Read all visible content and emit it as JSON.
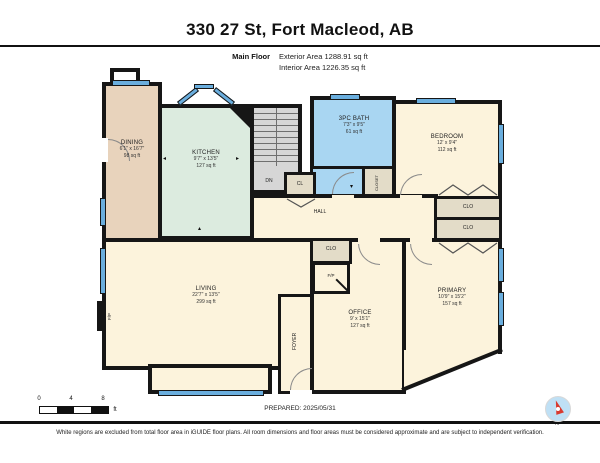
{
  "header": {
    "title": "330 27 St, Fort Macleod, AB",
    "floor_label": "Main Floor",
    "exterior_area": "Exterior Area 1288.91 sq ft",
    "interior_area": "Interior Area 1226.35 sq ft"
  },
  "rooms": {
    "dining": {
      "name": "DINING",
      "dims": "6'1\" x 16'7\"",
      "area": "98 sq ft"
    },
    "kitchen": {
      "name": "KITCHEN",
      "dims": "9'7\" x 13'5\"",
      "area": "127 sq ft"
    },
    "bath": {
      "name": "3PC BATH",
      "dims": "7'3\" x 9'5\"",
      "area": "61 sq ft"
    },
    "bedroom": {
      "name": "BEDROOM",
      "dims": "12' x 9'4\"",
      "area": "112 sq ft"
    },
    "living": {
      "name": "LIVING",
      "dims": "22'7\" x 13'5\"",
      "area": "299 sq ft"
    },
    "office": {
      "name": "OFFICE",
      "dims": "9' x 15'1\"",
      "area": "127 sq ft"
    },
    "primary": {
      "name": "PRIMARY",
      "dims": "10'9\" x 15'2\"",
      "area": "157 sq ft"
    }
  },
  "labels": {
    "hall": "HALL",
    "foyer": "FOYER",
    "dn": "DN",
    "cl": "CL",
    "closet": "CLOSET",
    "clo": "CLO",
    "fp": "F/P"
  },
  "scale": {
    "t0": "0",
    "t4": "4",
    "t8": "8",
    "unit": "ft"
  },
  "footer": {
    "prepared": "PREPARED: 2025/05/31",
    "compass_n": "N",
    "disclaimer": "White regions are excluded from total floor area in iGUIDE floor plans. All room dimensions and floor areas must be considered approximate and are subject to independent verification."
  },
  "colors": {
    "wall": "#161616",
    "window_blue": "#6aaede",
    "bath_blue": "#a9d6f2",
    "dining_tan": "#e8d3bc",
    "kitchen_mint": "#dcebdf",
    "room_cream": "#fcf3dc",
    "closet_khaki": "#e3dcc8",
    "stairs_gray": "#d6d6d6",
    "compass_red": "#d93a2f"
  }
}
